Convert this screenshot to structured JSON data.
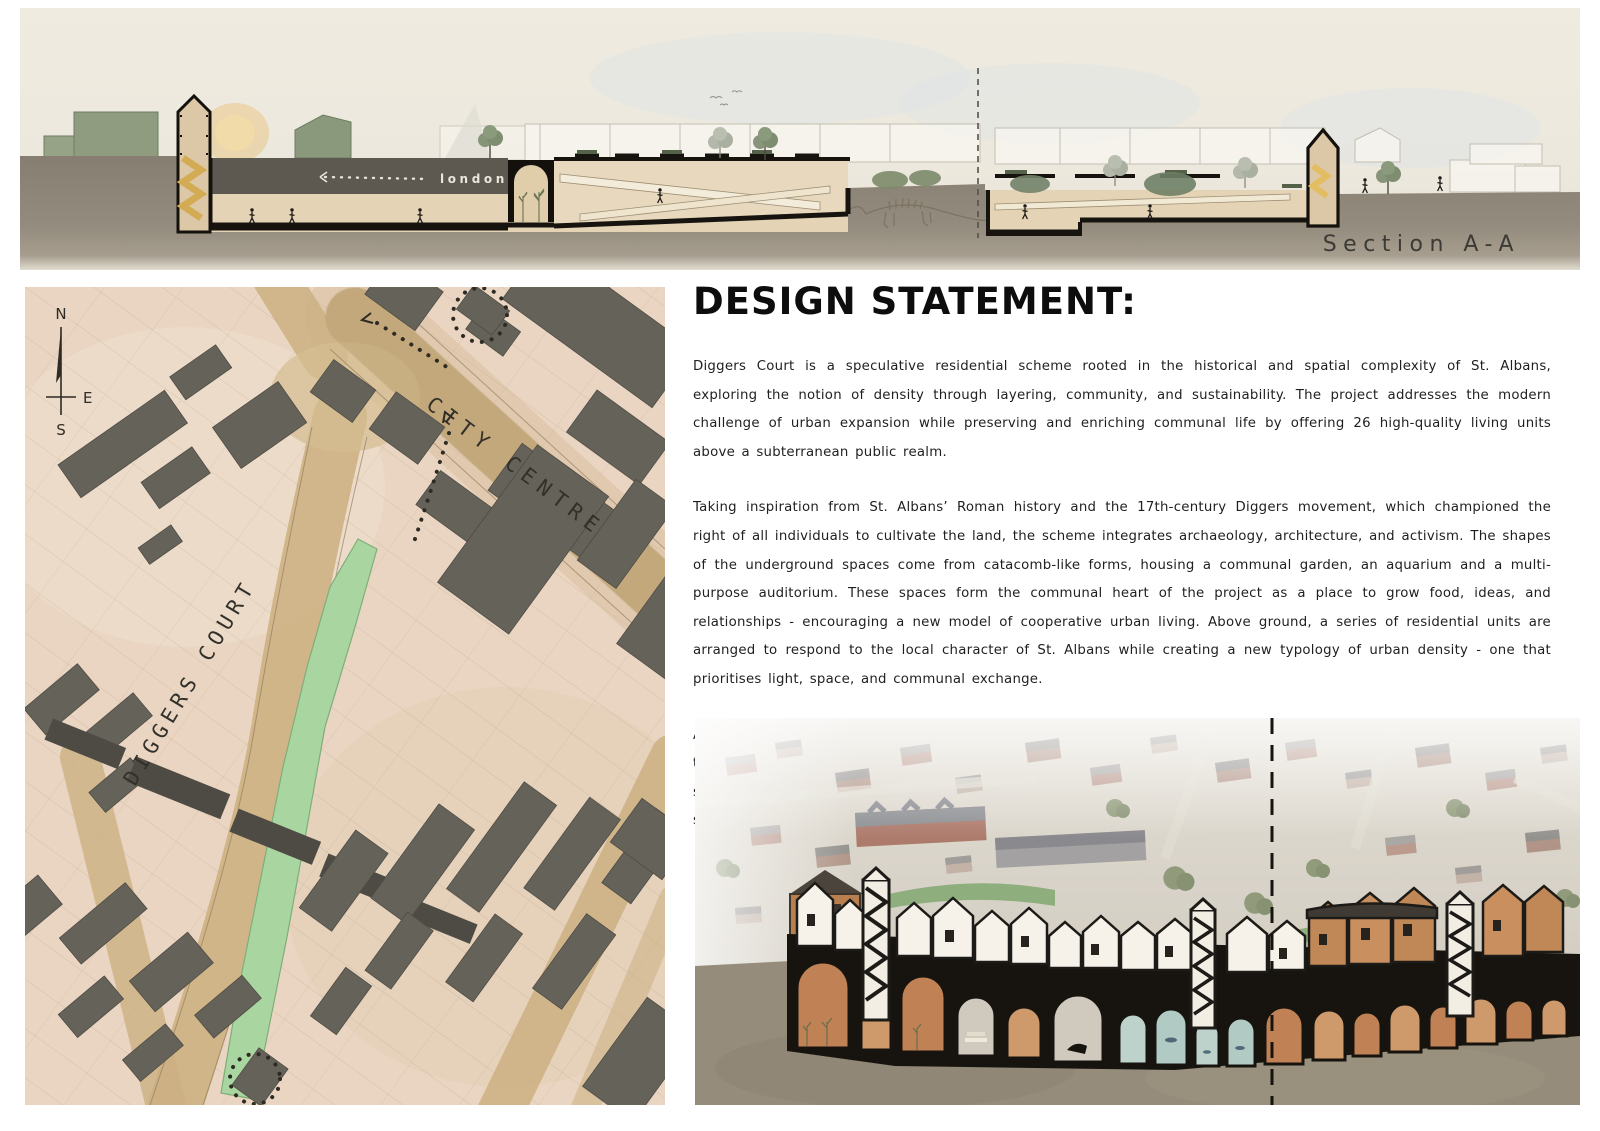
{
  "page": {
    "title": "Diggers Court design board",
    "colors": {
      "paper": "#ffffff",
      "map_paper": "#e9d5c1",
      "road_tan": "#cdb183",
      "site_green": "#a8d5a0",
      "ground_taupe": "#8d8679",
      "building_dark": "#65625a",
      "sage_building": "#8f9c80",
      "cut_beige": "#e5d3b6",
      "vault_tan": "#c5archive"
    }
  },
  "section_panel": {
    "label": "Section A-A",
    "road_label": "london road"
  },
  "site_plan": {
    "labels": {
      "main_road": "DIGGERS COURT",
      "secondary_road": "CITY CENTRE"
    },
    "compass": {
      "north": "N",
      "east": "E",
      "south": "S"
    }
  },
  "design_statement": {
    "heading": "DESIGN STATEMENT:",
    "paragraphs": [
      "Diggers Court is a speculative residential scheme rooted in the historical and spatial complexity of St. Albans, exploring the notion of density through layering, community, and sustainability. The project addresses the modern challenge of urban expansion while preserving and enriching communal life by offering 26 high-quality living units above a  subterranean public realm.",
      "Taking inspiration from St. Albans’ Roman history and the 17th-century Diggers movement, which championed the right of all individuals to cultivate the land, the scheme integrates archaeology, architecture, and activism. The shapes of the underground spaces come from catacomb-like forms, housing a communal garden, an aquarium and a multi-purpose auditorium. These spaces form the communal heart of the project as a place to grow food, ideas, and relationships - encouraging a new model of cooperative urban living. Above ground, a series of residential units are arranged to respond to the local character of St. Albans while creating a new typology of urban density - one that prioritises light, space, and communal exchange.",
      "At its core, Diggers Court is designed for a new kind of urban farming community - one that challenges the traditional, inherited nature of farmland and instead fosters a ‘farming family’ ethos in a shared urban context. The scheme reimagines agricultural practices in constrained urban environments, employing sustainable technologies and solar-powered grow lighting to reduce environmental impact and energy consumption."
    ]
  }
}
